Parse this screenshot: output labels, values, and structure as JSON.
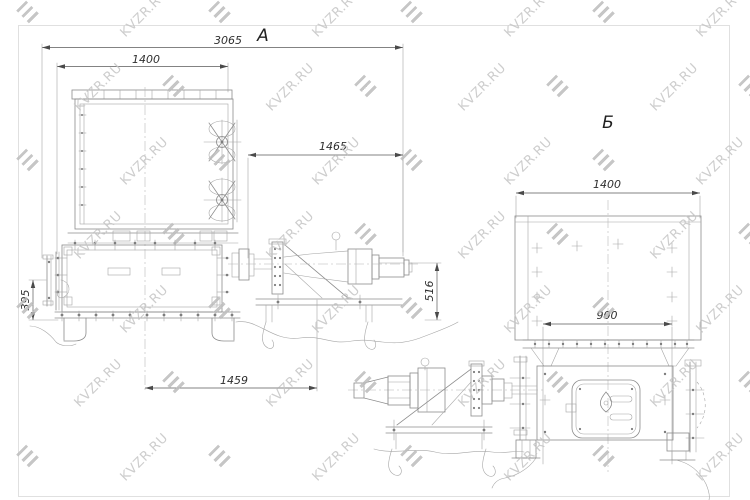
{
  "watermark": {
    "label": "KVZR.RU",
    "text_color": "#c5c5c5",
    "logo_color": "#bdbdbd",
    "grid": {
      "x0": 18,
      "y0": 6,
      "dx": 96,
      "dy": 74,
      "stagger": 50,
      "cols": 8,
      "rows": 7
    }
  },
  "drawing": {
    "line_color": "#8c8c8c",
    "dimension_color": "#5a5a5a",
    "background": "#ffffff"
  },
  "view_a": {
    "label": "А",
    "dims": {
      "overall": "3065",
      "box_width": "1400",
      "motor_span": "1465",
      "bracket_height": "395",
      "motor_height": "516",
      "center_to_motor": "1459"
    }
  },
  "view_b": {
    "label": "Б",
    "dims": {
      "box_width": "1400",
      "bolt_span": "900"
    }
  }
}
